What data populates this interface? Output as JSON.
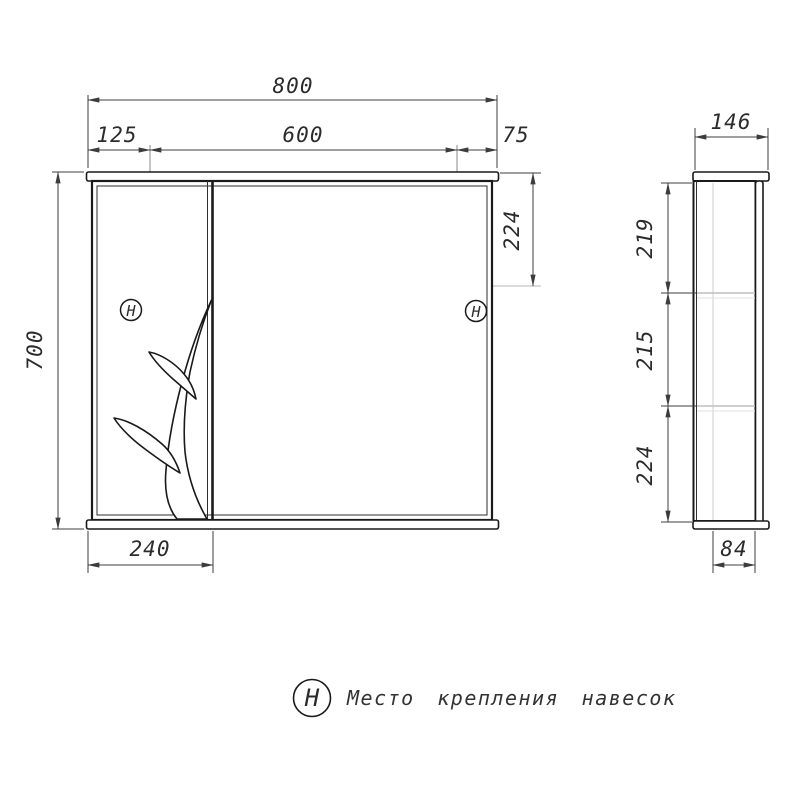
{
  "drawing": {
    "front_view": {
      "dim_total_width": "800",
      "dim_left_section": "125",
      "dim_mirror_section": "600",
      "dim_right_section": "75",
      "dim_total_height": "700",
      "dim_hanger_top_offset": "224",
      "dim_door_width": "240",
      "hanger_symbol": "H"
    },
    "side_view": {
      "dim_depth": "146",
      "dim_top_section": "219",
      "dim_middle_section": "215",
      "dim_bottom_section": "224",
      "dim_bottom_depth": "84"
    },
    "legend": {
      "symbol": "H",
      "caption": "Место крепления навесок"
    },
    "colors": {
      "line": "#1a1a1a",
      "dimension": "#3c3c3c",
      "construction": "#b5b5b5",
      "background": "#ffffff"
    }
  }
}
